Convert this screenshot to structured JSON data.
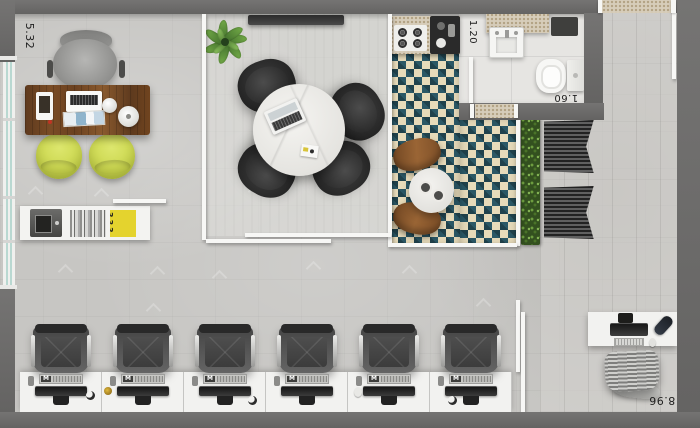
{
  "plan": {
    "type": "office-floor-plan-top-view",
    "dimension_labels": {
      "left_wall_width": "5.32",
      "bathroom_width": "1.20",
      "bathroom_depth": "1.60",
      "right_wall_depth": "8.96"
    },
    "workstation": {
      "keyboard_logo": "M",
      "count": 6
    },
    "shelf": {
      "magazine_spine": "333"
    },
    "colors": {
      "wall": "#6b6b6b",
      "floor": "#c7c6c3",
      "meeting_floor": "#d6d5d1",
      "tile_teal": "#2b5866",
      "tile_cream": "#e7dbba",
      "hedge_green": "#33501f",
      "guest_chair_yellow": "#ccd94e",
      "desk_wood": "#6f4522",
      "window_glass": "#b9d8d1"
    }
  }
}
